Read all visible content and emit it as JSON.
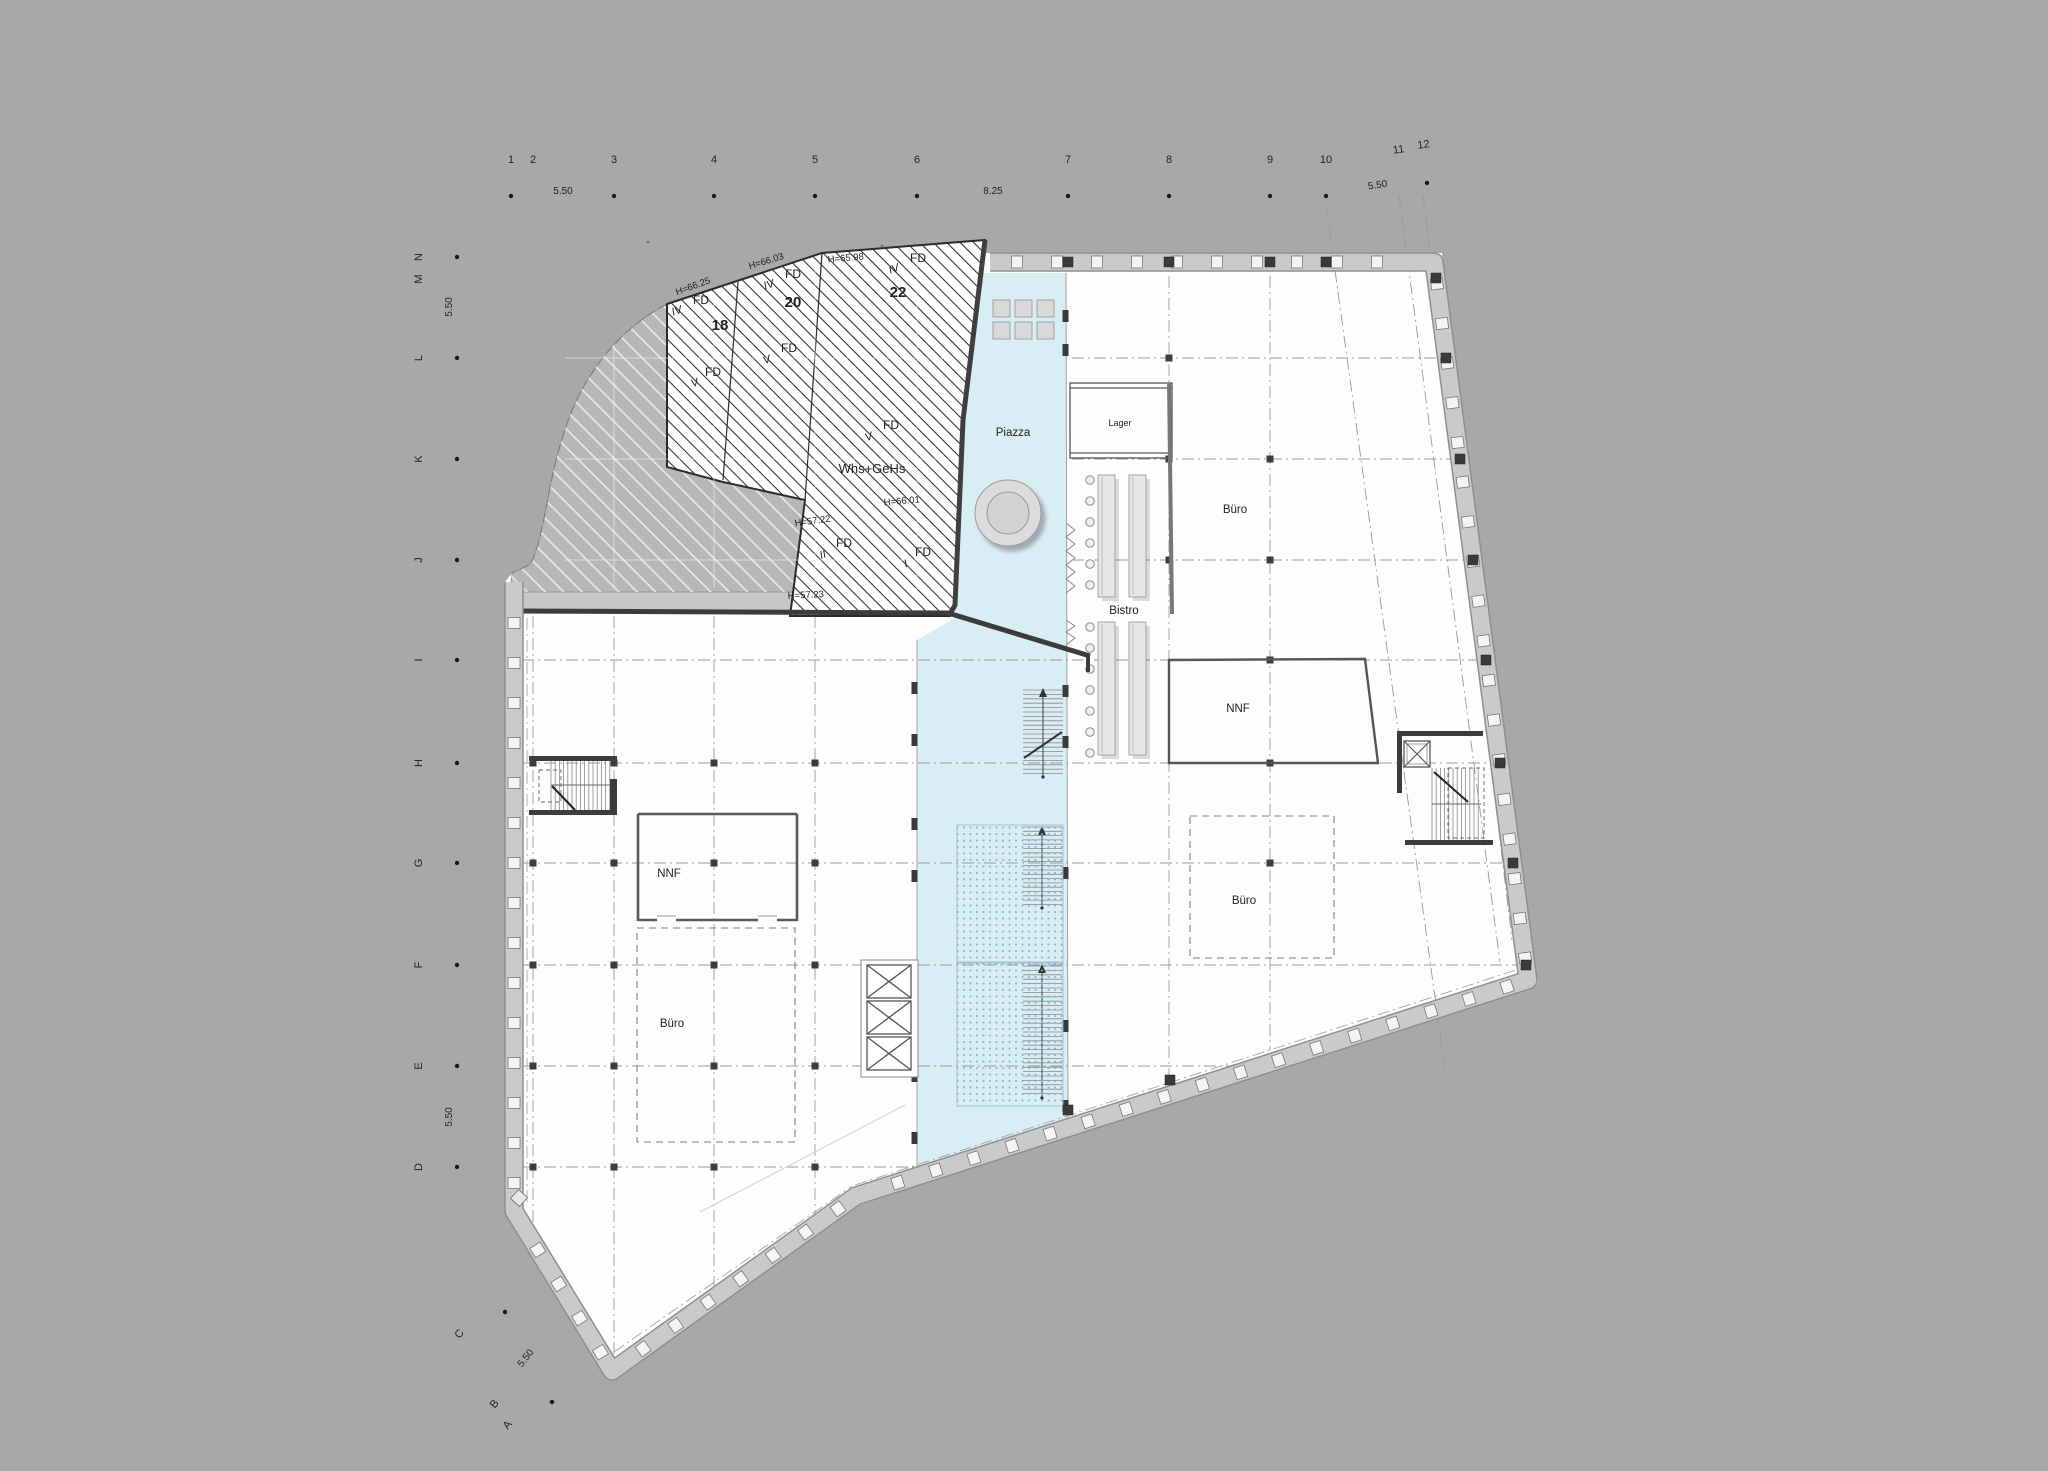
{
  "title": "floor-plan",
  "colors": {
    "background": "#a8a8a8",
    "facade": "#cacaca",
    "facade_edge": "#8f8f8f",
    "interior": "#fdfdfd",
    "piazza_blue": "#d9edf4",
    "ramp_dot": "#7fb3c8",
    "roof_light": "#b7b7b7",
    "hatch_dark_line": "#2d2d2d",
    "wall_dark": "#3c3c3c",
    "grid_line": "#999999",
    "text": "#222222"
  },
  "axes": {
    "top": {
      "numbers": [
        {
          "t": "1",
          "x": 511,
          "y": 163
        },
        {
          "t": "2",
          "x": 533,
          "y": 163
        },
        {
          "t": "3",
          "x": 614,
          "y": 163
        },
        {
          "t": "4",
          "x": 714,
          "y": 163
        },
        {
          "t": "5",
          "x": 815,
          "y": 163
        },
        {
          "t": "6",
          "x": 917,
          "y": 163
        },
        {
          "t": "7",
          "x": 1068,
          "y": 163
        },
        {
          "t": "8",
          "x": 1169,
          "y": 163
        },
        {
          "t": "9",
          "x": 1270,
          "y": 163
        },
        {
          "t": "10",
          "x": 1326,
          "y": 163
        },
        {
          "t": "11",
          "x": 1399,
          "y": 153,
          "r": -8
        },
        {
          "t": "12",
          "x": 1424,
          "y": 148,
          "r": -8
        }
      ],
      "dims": [
        {
          "t": "5.50",
          "x": 563,
          "y": 194
        },
        {
          "t": "8.25",
          "x": 993,
          "y": 194
        },
        {
          "t": "5.50",
          "x": 1378,
          "y": 188,
          "r": -8
        }
      ]
    },
    "left": {
      "letters": [
        {
          "t": "N",
          "y": 257
        },
        {
          "t": "M",
          "y": 279
        },
        {
          "t": "L",
          "y": 358
        },
        {
          "t": "K",
          "y": 459
        },
        {
          "t": "J",
          "y": 560
        },
        {
          "t": "I",
          "y": 660
        },
        {
          "t": "H",
          "y": 763
        },
        {
          "t": "G",
          "y": 863
        },
        {
          "t": "F",
          "y": 965
        },
        {
          "t": "E",
          "y": 1066
        },
        {
          "t": "D",
          "y": 1167
        }
      ],
      "dims": [
        {
          "t": "5.50",
          "y": 307
        },
        {
          "t": "5.50",
          "y": 1117
        }
      ]
    },
    "corner": {
      "letters": [
        {
          "t": "C",
          "x": 462,
          "y": 1336,
          "r": -52
        },
        {
          "t": "B",
          "x": 497,
          "y": 1406,
          "r": -52
        },
        {
          "t": "A",
          "x": 510,
          "y": 1427,
          "r": -52
        }
      ],
      "dim": {
        "t": "5.50",
        "x": 528,
        "y": 1360,
        "r": -52
      }
    }
  },
  "roof": {
    "heights": [
      {
        "t": "H=66.25",
        "x": 694,
        "y": 289,
        "r": -20
      },
      {
        "t": "H=66.03",
        "x": 767,
        "y": 264,
        "r": -17
      },
      {
        "t": "H=65.98",
        "x": 846,
        "y": 261,
        "r": -5
      },
      {
        "t": "H=66.01",
        "x": 902,
        "y": 504,
        "r": -5
      },
      {
        "t": "H=57.22",
        "x": 813,
        "y": 524,
        "r": -8
      },
      {
        "t": "H=57.23",
        "x": 806,
        "y": 598,
        "r": -3
      }
    ],
    "fd": [
      {
        "pre": "IV",
        "px": 678,
        "py": 314,
        "t": "FD",
        "x": 701,
        "y": 304
      },
      {
        "pre": "IV",
        "px": 770,
        "py": 288,
        "t": "FD",
        "x": 793,
        "y": 278
      },
      {
        "pre": "IV",
        "px": 895,
        "py": 272,
        "t": "FD",
        "x": 918,
        "y": 262
      },
      {
        "pre": "V",
        "px": 696,
        "py": 386,
        "t": "FD",
        "x": 713,
        "y": 376
      },
      {
        "pre": "V",
        "px": 768,
        "py": 363,
        "t": "FD",
        "x": 789,
        "y": 352
      },
      {
        "pre": "V",
        "px": 870,
        "py": 440,
        "t": "FD",
        "x": 891,
        "y": 429
      },
      {
        "pre": "II",
        "px": 824,
        "py": 558,
        "t": "FD",
        "x": 844,
        "y": 547
      },
      {
        "pre": "I",
        "px": 907,
        "py": 567,
        "t": "FD",
        "x": 923,
        "y": 556
      }
    ],
    "panels": [
      {
        "t": "18",
        "x": 720,
        "y": 330
      },
      {
        "t": "20",
        "x": 793,
        "y": 307
      },
      {
        "t": "22",
        "x": 898,
        "y": 297
      }
    ],
    "name": {
      "t": "Whs+GeHs",
      "x": 872,
      "y": 473
    }
  },
  "rooms": [
    {
      "key": "piazza",
      "t": "Piazza",
      "x": 1013,
      "y": 436
    },
    {
      "key": "lager",
      "t": "Lager",
      "x": 1120,
      "y": 426,
      "s": 9
    },
    {
      "key": "bistro",
      "t": "Bistro",
      "x": 1124,
      "y": 614
    },
    {
      "key": "buero-right",
      "t": "Büro",
      "x": 1235,
      "y": 513
    },
    {
      "key": "nnf-right",
      "t": "NNF",
      "x": 1238,
      "y": 712
    },
    {
      "key": "buero-bottom-right",
      "t": "Büro",
      "x": 1244,
      "y": 904
    },
    {
      "key": "nnf-left",
      "t": "NNF",
      "x": 669,
      "y": 877
    },
    {
      "key": "buero-left",
      "t": "Büro",
      "x": 672,
      "y": 1027
    }
  ]
}
